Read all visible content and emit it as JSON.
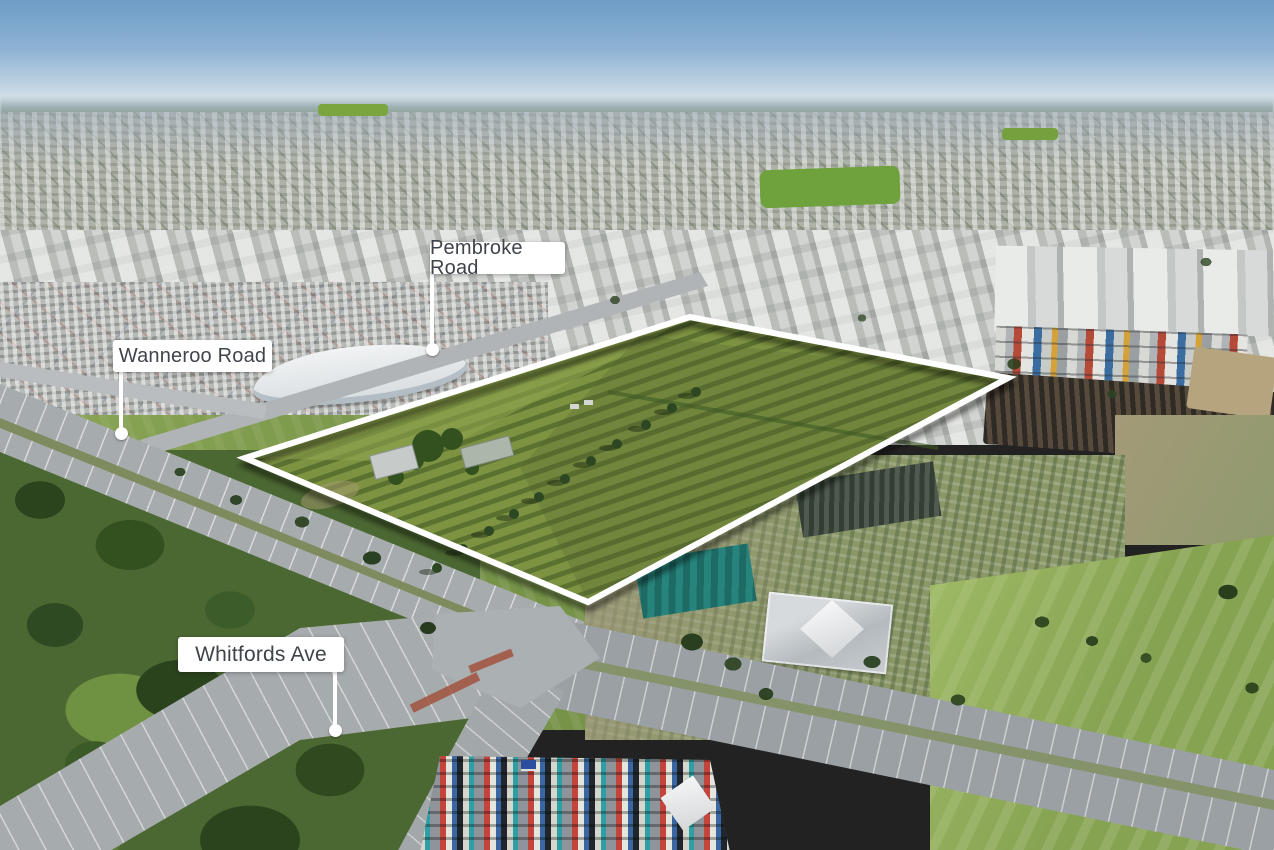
{
  "annotations": {
    "road_labels": [
      {
        "id": "pembroke-road",
        "text": "Pembroke Road"
      },
      {
        "id": "wanneroo-road",
        "text": "Wanneroo Road"
      },
      {
        "id": "whitfords-ave",
        "text": "Whitfords Ave"
      }
    ]
  },
  "property_outline": {
    "stroke_color": "#ffffff",
    "vertices_px": [
      [
        245,
        458
      ],
      [
        690,
        317
      ],
      [
        1008,
        378
      ],
      [
        588,
        602
      ]
    ]
  },
  "colors": {
    "label_background": "#ffffff",
    "label_text": "#3f444a",
    "leader_line": "#ffffff",
    "boundary_stroke": "#ffffff",
    "boundary_shadow": "rgba(0,0,0,0.55)",
    "field_row_light": "#7d9342",
    "field_row_dark": "#5b7130",
    "sky_top": "#6e9dc7",
    "road_asphalt": "#a6abae"
  }
}
